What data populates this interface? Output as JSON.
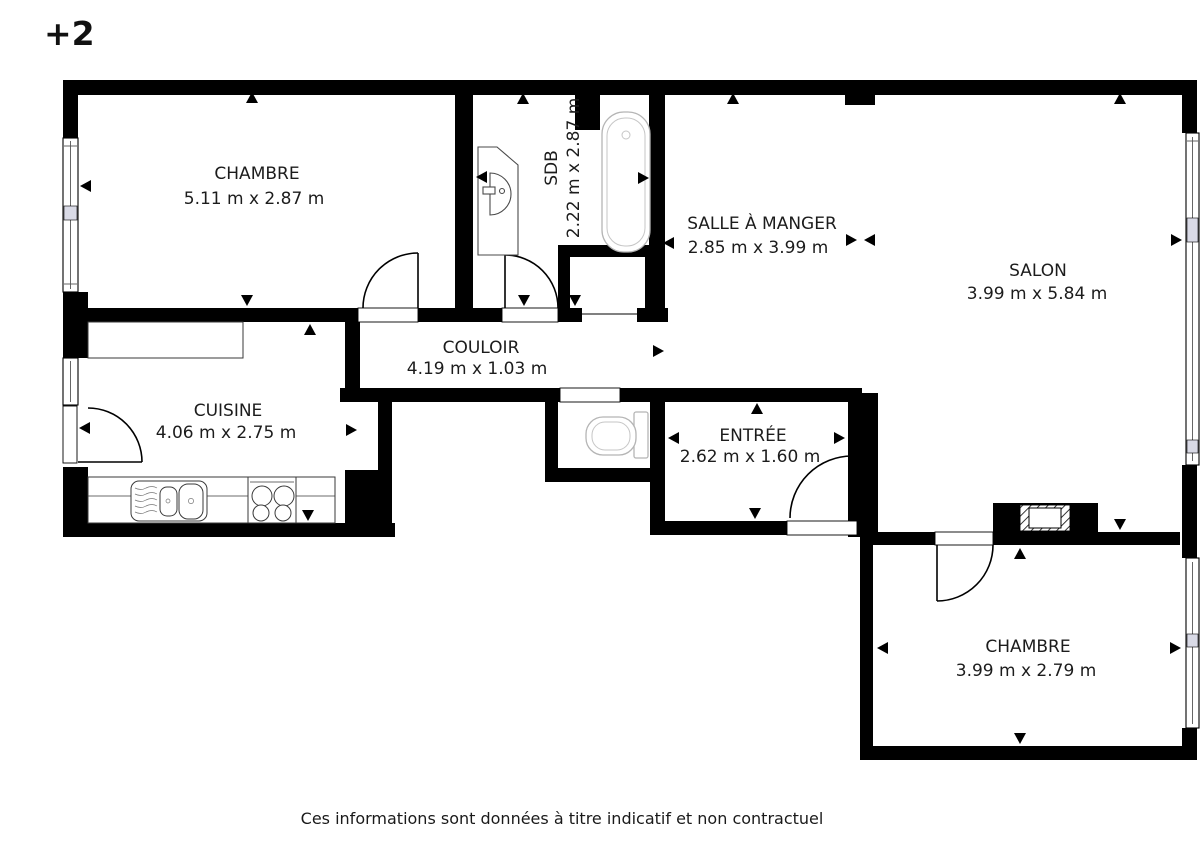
{
  "floor_indicator": "+2",
  "rooms": [
    {
      "id": "chambre-1",
      "name": "CHAMBRE",
      "dimensions": "5.11 m x 2.87 m"
    },
    {
      "id": "sdb",
      "name": "SDB",
      "dimensions": "2.22 m x 2.87 m"
    },
    {
      "id": "salle-a-manger",
      "name": "SALLE À MANGER",
      "dimensions": "2.85 m x 3.99 m"
    },
    {
      "id": "salon",
      "name": "SALON",
      "dimensions": "3.99 m x 5.84 m"
    },
    {
      "id": "couloir",
      "name": "COULOIR",
      "dimensions": "4.19 m x 1.03 m"
    },
    {
      "id": "cuisine",
      "name": "CUISINE",
      "dimensions": "4.06 m x 2.75 m"
    },
    {
      "id": "entree",
      "name": "ENTRÉE",
      "dimensions": "2.62 m x 1.60 m"
    },
    {
      "id": "chambre-2",
      "name": "CHAMBRE",
      "dimensions": "3.99 m x 2.79 m"
    }
  ],
  "footer": {
    "disclaimer": "Ces informations sont données à titre indicatif et non contractuel"
  },
  "colors": {
    "walls": "#000000",
    "text": "#1c1c1c",
    "fixtures_light": "#b5b5b5",
    "fixtures_dark": "#4a4a4a",
    "background": "#ffffff",
    "window_glass": "#d9dae6"
  }
}
